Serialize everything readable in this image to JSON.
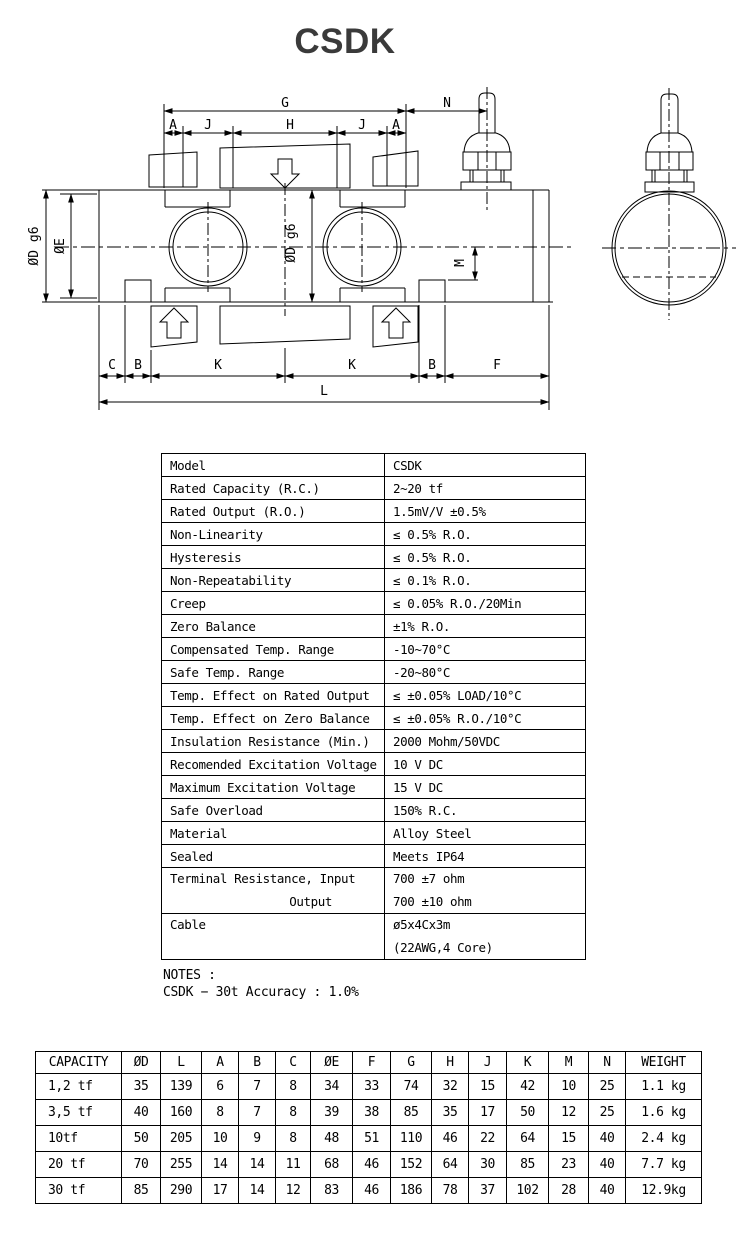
{
  "title": "CSDK",
  "drawing": {
    "labels": {
      "g": "G",
      "n": "N",
      "a_left": "A",
      "j_left": "J",
      "h": "H",
      "j_right": "J",
      "a_right": "A",
      "dia_d_left": "ØD g6",
      "dia_e": "ØE",
      "dia_d_center": "ØD g6",
      "m": "M",
      "c": "C",
      "b_left": "B",
      "k_left": "K",
      "k_right": "K",
      "b_right": "B",
      "f": "F",
      "l": "L"
    }
  },
  "spec_table": {
    "rows": [
      {
        "label": "Model",
        "value": "CSDK"
      },
      {
        "label": "Rated Capacity (R.C.)",
        "value": "2~20 tf"
      },
      {
        "label": "Rated Output (R.O.)",
        "value": "1.5mV/V ±0.5%"
      },
      {
        "label": "Non-Linearity",
        "value": "≤ 0.5% R.O."
      },
      {
        "label": "Hysteresis",
        "value": "≤ 0.5% R.O."
      },
      {
        "label": "Non-Repeatability",
        "value": "≤ 0.1% R.O."
      },
      {
        "label": "Creep",
        "value": "≤ 0.05% R.O./20Min"
      },
      {
        "label": "Zero Balance",
        "value": "±1% R.O."
      },
      {
        "label": "Compensated Temp. Range",
        "value": "-10~70°C"
      },
      {
        "label": "Safe Temp. Range",
        "value": "-20~80°C"
      },
      {
        "label": "Temp. Effect on Rated Output",
        "value": "≤ ±0.05% LOAD/10°C"
      },
      {
        "label": "Temp. Effect on Zero Balance",
        "value": "≤ ±0.05% R.O./10°C"
      },
      {
        "label": "Insulation Resistance (Min.)",
        "value": "2000 Mohm/50VDC"
      },
      {
        "label": "Recomended Excitation Voltage",
        "value": "10 V DC"
      },
      {
        "label": "Maximum Excitation Voltage",
        "value": "15 V DC"
      },
      {
        "label": "Safe Overload",
        "value": "150% R.C."
      },
      {
        "label": "Material",
        "value": "Alloy Steel"
      },
      {
        "label": "Sealed",
        "value": "Meets IP64"
      },
      {
        "label": "Terminal Resistance, Input",
        "label2": "Output",
        "value": "700 ±7 ohm",
        "value2": "700 ±10 ohm"
      },
      {
        "label": "Cable",
        "value": "ø5x4Cx3m",
        "value2": "(22AWG,4 Core)"
      }
    ]
  },
  "notes": {
    "line1": "NOTES :",
    "line2": "CSDK − 30t Accuracy : 1.0%"
  },
  "dim_table": {
    "headers": [
      "CAPACITY",
      "ØD",
      "L",
      "A",
      "B",
      "C",
      "ØE",
      "F",
      "G",
      "H",
      "J",
      "K",
      "M",
      "N",
      "WEIGHT"
    ],
    "rows": [
      [
        "1,2 tf",
        "35",
        "139",
        "6",
        "7",
        "8",
        "34",
        "33",
        "74",
        "32",
        "15",
        "42",
        "10",
        "25",
        "1.1 kg"
      ],
      [
        "3,5 tf",
        "40",
        "160",
        "8",
        "7",
        "8",
        "39",
        "38",
        "85",
        "35",
        "17",
        "50",
        "12",
        "25",
        "1.6 kg"
      ],
      [
        "10tf",
        "50",
        "205",
        "10",
        "9",
        "8",
        "48",
        "51",
        "110",
        "46",
        "22",
        "64",
        "15",
        "40",
        "2.4 kg"
      ],
      [
        "20 tf",
        "70",
        "255",
        "14",
        "14",
        "11",
        "68",
        "46",
        "152",
        "64",
        "30",
        "85",
        "23",
        "40",
        "7.7 kg"
      ],
      [
        "30 tf",
        "85",
        "290",
        "17",
        "14",
        "12",
        "83",
        "46",
        "186",
        "78",
        "37",
        "102",
        "28",
        "40",
        "12.9kg"
      ]
    ]
  }
}
